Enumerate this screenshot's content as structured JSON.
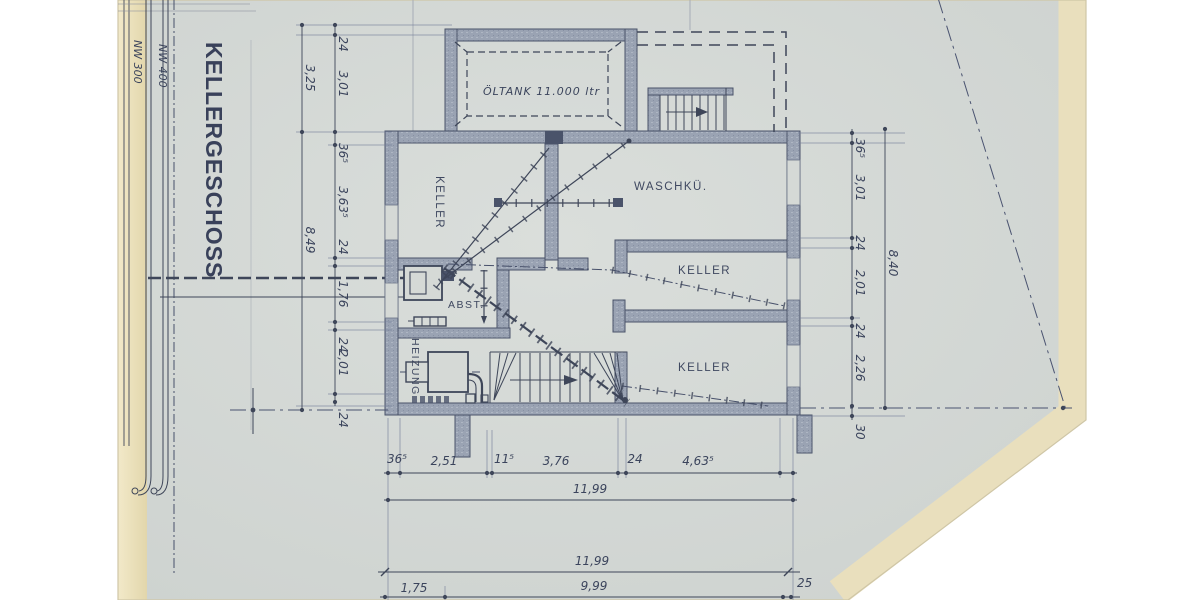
{
  "title": "KELLERGESCHOSS",
  "colors": {
    "paper": "#d5d9d6",
    "paper_edge": "#e9dfbd",
    "ink": "#3e4659",
    "wall_fill": "#9aa3b3"
  },
  "pipes": {
    "nw300": "NW 300",
    "nw400": "NW 400"
  },
  "rooms": {
    "oeltank": "ÖLTANK 11.000 ltr",
    "keller_west": "KELLER",
    "waschkueche": "WASCHKÜ.",
    "keller_mitte": "KELLER",
    "keller_sued": "KELLER",
    "abstellraum": "ABST.",
    "heizung": "HEIZUNG"
  },
  "dims": {
    "left_outer": [
      "3,25",
      "8,49"
    ],
    "left_inner": [
      "24",
      "3,01",
      "36⁵",
      "3,63⁵",
      "24",
      "1,76",
      "24",
      "2,01",
      "24"
    ],
    "right_inner": [
      "36⁵",
      "3,01",
      "24",
      "2,01",
      "24",
      "2,26",
      "30"
    ],
    "right_outer": [
      "8,40"
    ],
    "bottom": [
      "36⁵",
      "2,51",
      "11⁵",
      "3,76",
      "24",
      "4,63⁵"
    ],
    "bottom_total": "11,99",
    "site_total": "11,99",
    "site": [
      "1,75",
      "9,99",
      "25"
    ]
  }
}
